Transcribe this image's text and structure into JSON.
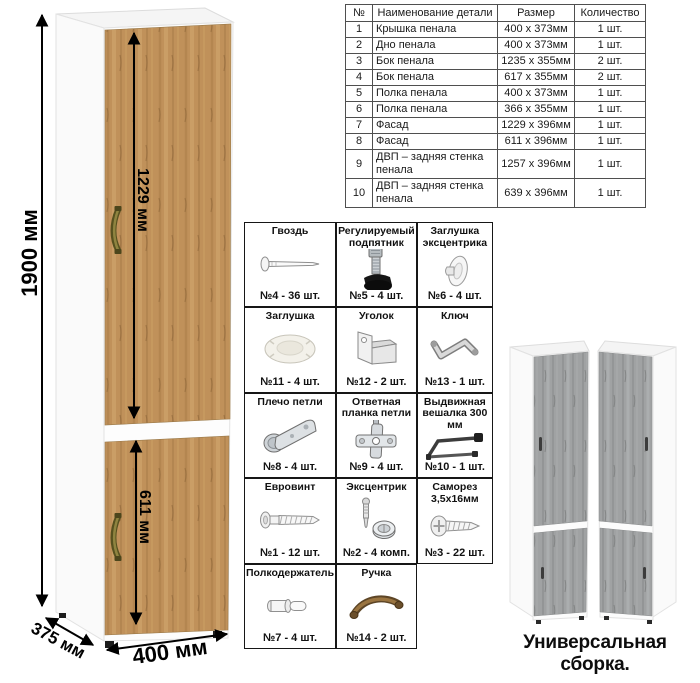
{
  "sheet": {
    "dimensions": {
      "height": "1900 мм",
      "upper_door": "1229 мм",
      "lower_door": "611 мм",
      "width": "400 мм",
      "depth": "375 мм"
    },
    "parts_table": {
      "headers": [
        "№",
        "Наименование детали",
        "Размер",
        "Количество"
      ],
      "rows": [
        [
          "1",
          "Крышка пенала",
          "400 х 373мм",
          "1 шт."
        ],
        [
          "2",
          "Дно пенала",
          "400 х 373мм",
          "1 шт."
        ],
        [
          "3",
          "Бок пенала",
          "1235 х 355мм",
          "2 шт."
        ],
        [
          "4",
          "Бок пенала",
          "617 х 355мм",
          "2 шт."
        ],
        [
          "5",
          "Полка пенала",
          "400 х 373мм",
          "1 шт."
        ],
        [
          "6",
          "Полка пенала",
          "366 х 355мм",
          "1 шт."
        ],
        [
          "7",
          "Фасад",
          "1229 х 396мм",
          "1 шт."
        ],
        [
          "8",
          "Фасад",
          "611 х 396мм",
          "1 шт."
        ],
        [
          "9",
          "ДВП – задняя стенка пенала",
          "1257 х 396мм",
          "1 шт."
        ],
        [
          "10",
          "ДВП – задняя стенка пенала",
          "639 х 396мм",
          "1 шт."
        ]
      ]
    },
    "hardware": {
      "items": [
        {
          "label": "Гвоздь",
          "count": "№4 - 36 шт.",
          "icon": "nail-icon"
        },
        {
          "label": "Регулируемый подпятник",
          "count": "№5 - 4 шт.",
          "icon": "adjustable-foot-icon"
        },
        {
          "label": "Заглушка эксцентрика",
          "count": "№6 - 4 шт.",
          "icon": "cam-cap-icon"
        },
        {
          "label": "Заглушка",
          "count": "№11 - 4 шт.",
          "icon": "cap-icon"
        },
        {
          "label": "Уголок",
          "count": "№12 - 2 шт.",
          "icon": "corner-bracket-icon"
        },
        {
          "label": "Ключ",
          "count": "№13 - 1 шт.",
          "icon": "hex-key-icon"
        },
        {
          "label": "Плечо петли",
          "count": "№8 - 4 шт.",
          "icon": "hinge-arm-icon"
        },
        {
          "label": "Ответная планка петли",
          "count": "№9 - 4 шт.",
          "icon": "hinge-plate-icon"
        },
        {
          "label": "Выдвижная вешалка 300 мм",
          "count": "№10 - 1 шт.",
          "icon": "pullout-hanger-icon"
        },
        {
          "label": "Евровинт",
          "count": "№1 - 12 шт.",
          "icon": "euro-screw-icon"
        },
        {
          "label": "Эксцентрик",
          "count": "№2 - 4 комп.",
          "icon": "cam-lock-icon"
        },
        {
          "label": "Саморез 3,5х16мм",
          "count": "№3 - 22 шт.",
          "icon": "self-tapping-screw-icon"
        },
        {
          "label": "Полкодержатель",
          "count": "№7 - 4 шт.",
          "icon": "shelf-pin-icon"
        },
        {
          "label": "Ручка",
          "count": "№14 - 2 шт.",
          "icon": "handle-icon"
        }
      ]
    },
    "variants": {
      "caption": "Универсальная сборка."
    },
    "colors": {
      "oak_wood": "#c0915a",
      "gray_wood": "#a0a2a3",
      "carcass_white": "#fcfcfc",
      "handle_bronze": "#6f672c",
      "dimension_black": "#000000"
    }
  }
}
